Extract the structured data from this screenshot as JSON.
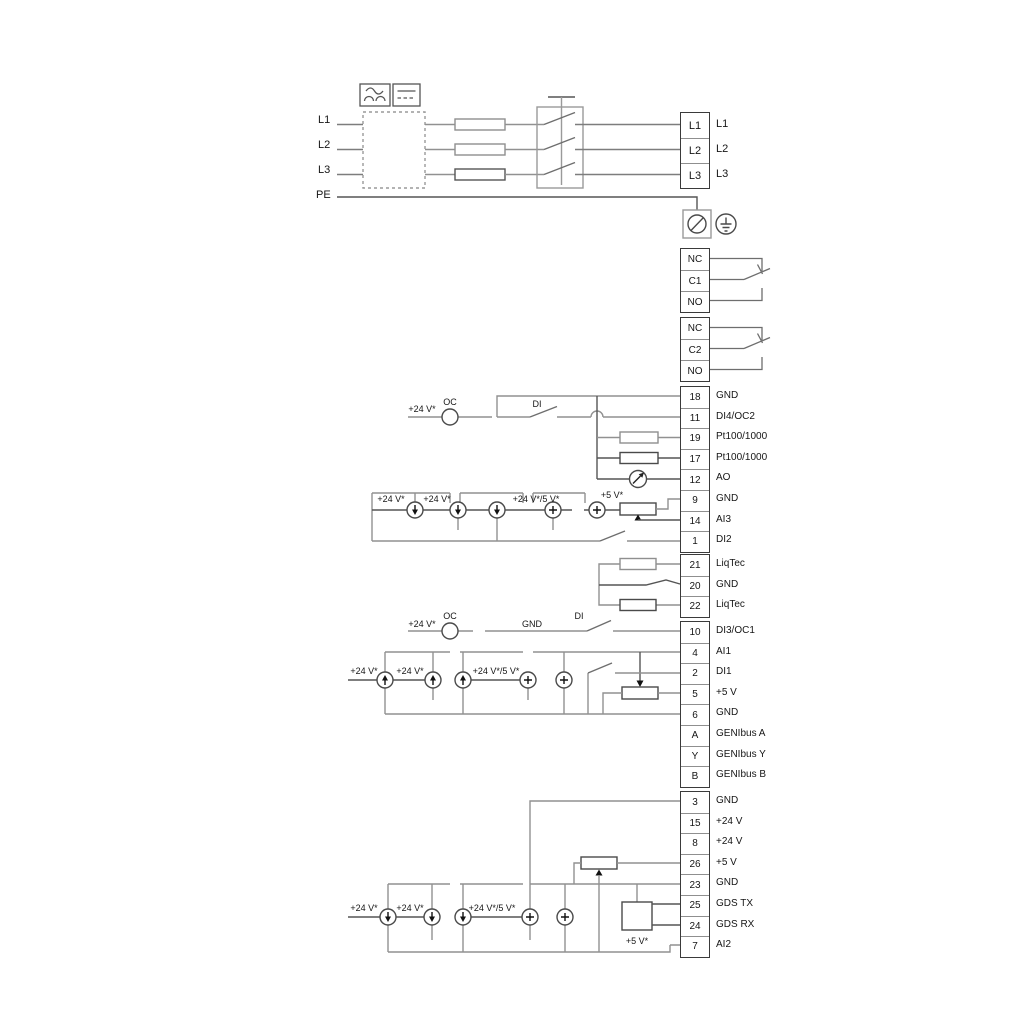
{
  "mains": {
    "in": [
      "L1",
      "L2",
      "L3",
      "PE"
    ],
    "out": [
      "L1",
      "L2",
      "L3"
    ]
  },
  "relays": {
    "r1": [
      "NC",
      "C1",
      "NO"
    ],
    "r2": [
      "NC",
      "C2",
      "NO"
    ]
  },
  "io_upper": {
    "rows": [
      {
        "no": "18",
        "label": "GND"
      },
      {
        "no": "11",
        "label": "DI4/OC2"
      },
      {
        "no": "19",
        "label": "Pt100/1000"
      },
      {
        "no": "17",
        "label": "Pt100/1000"
      },
      {
        "no": "12",
        "label": "AO"
      },
      {
        "no": "9",
        "label": "GND"
      },
      {
        "no": "14",
        "label": "AI3"
      },
      {
        "no": "1",
        "label": "DI2"
      }
    ]
  },
  "liqtec": {
    "rows": [
      {
        "no": "21",
        "label": "LiqTec"
      },
      {
        "no": "20",
        "label": "GND"
      },
      {
        "no": "22",
        "label": "LiqTec"
      }
    ]
  },
  "io_mid": {
    "rows": [
      {
        "no": "10",
        "label": "DI3/OC1"
      },
      {
        "no": "4",
        "label": "AI1"
      },
      {
        "no": "2",
        "label": "DI1"
      },
      {
        "no": "5",
        "label": "+5 V"
      },
      {
        "no": "6",
        "label": "GND"
      },
      {
        "no": "A",
        "label": "GENIbus A"
      },
      {
        "no": "Y",
        "label": "GENIbus Y"
      },
      {
        "no": "B",
        "label": "GENIbus B"
      }
    ]
  },
  "io_low": {
    "rows": [
      {
        "no": "3",
        "label": "GND"
      },
      {
        "no": "15",
        "label": "+24 V"
      },
      {
        "no": "8",
        "label": "+24 V"
      },
      {
        "no": "26",
        "label": "+5 V"
      },
      {
        "no": "23",
        "label": "GND"
      },
      {
        "no": "25",
        "label": "GDS TX"
      },
      {
        "no": "24",
        "label": "GDS RX"
      },
      {
        "no": "7",
        "label": "AI2"
      }
    ]
  },
  "ann": {
    "v24": "+24 V*",
    "v24v5": "+24 V*/5 V*",
    "v5": "+5 V*",
    "oc": "OC",
    "di": "DI",
    "gnd": "GND"
  },
  "colors": {
    "wire_gray": "#919191",
    "wire_dark": "#4a4a4a",
    "text": "#161616"
  }
}
